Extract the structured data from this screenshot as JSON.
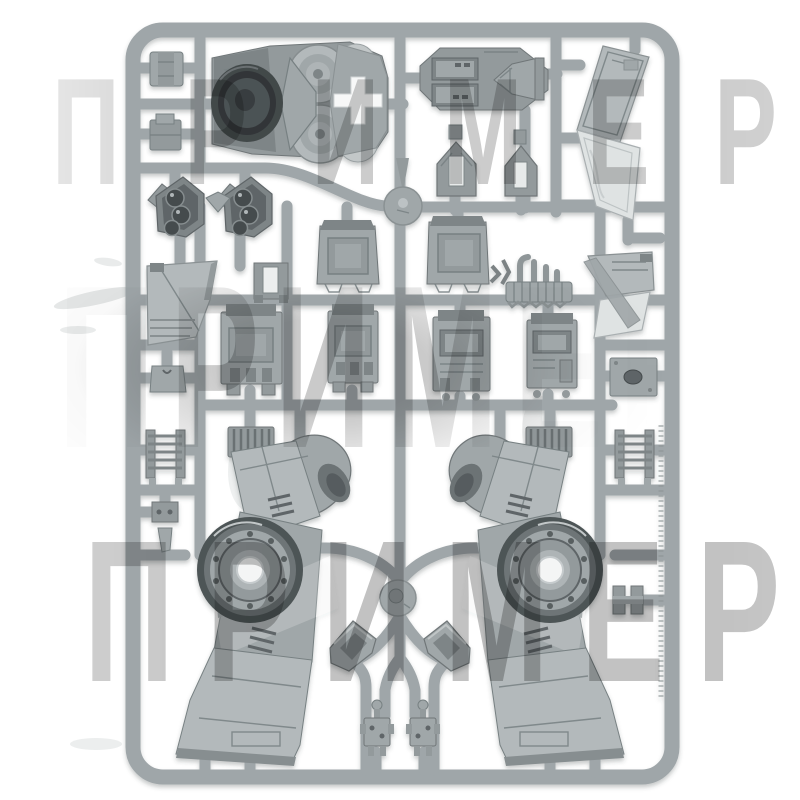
{
  "photo": {
    "background_color": "#ffffff",
    "subject": "grey plastic model-kit sprue (injection-moulded frame holding vehicle/walker parts)"
  },
  "watermark": {
    "text": "ПРИМЕР",
    "color": "#c6c6c6",
    "blend": "multiply",
    "bands": [
      "top",
      "middle",
      "bottom"
    ]
  },
  "palette": {
    "runner_grey": "#9fa6a9",
    "part_light": "#b3b9bb",
    "part_mid": "#a0a7a9",
    "part_dark": "#7e8587",
    "turbine_dark": "#42484a",
    "panel_highlight": "#dfe3e3",
    "cutout_white": "#f7f8f8"
  },
  "parts": [
    "sprue-frame",
    "runner-network",
    "turbine-intake-part",
    "hull-roof-hatch-part",
    "tail-wing-panel-part",
    "clip-part-top-1",
    "clip-part-top-2",
    "sensor-pod-part-1",
    "sensor-pod-part-2",
    "vent-house-part-1",
    "vent-house-part-2",
    "recessed-box-part-left",
    "recessed-box-part-right",
    "h-bracket-part",
    "armor-wedge-part-left",
    "armor-wedge-part-right",
    "exhaust-manifold-part",
    "hatch-box-part-1",
    "hatch-box-part-2",
    "hatch-box-part-3",
    "hatch-box-part-4",
    "porthole-plate-part",
    "notch-plate-part",
    "ladder-part-left",
    "ladder-part-right",
    "grille-part-left",
    "grille-part-right",
    "rail-clip-part",
    "rail-bracket-part",
    "leg-fuselage-part-left",
    "leg-fuselage-part-right",
    "elbow-duct-part-left",
    "elbow-duct-part-right",
    "antenna-greeble-part-1",
    "antenna-greeble-part-2",
    "runner-hub-top",
    "runner-hub-bottom",
    "molding-marks"
  ]
}
